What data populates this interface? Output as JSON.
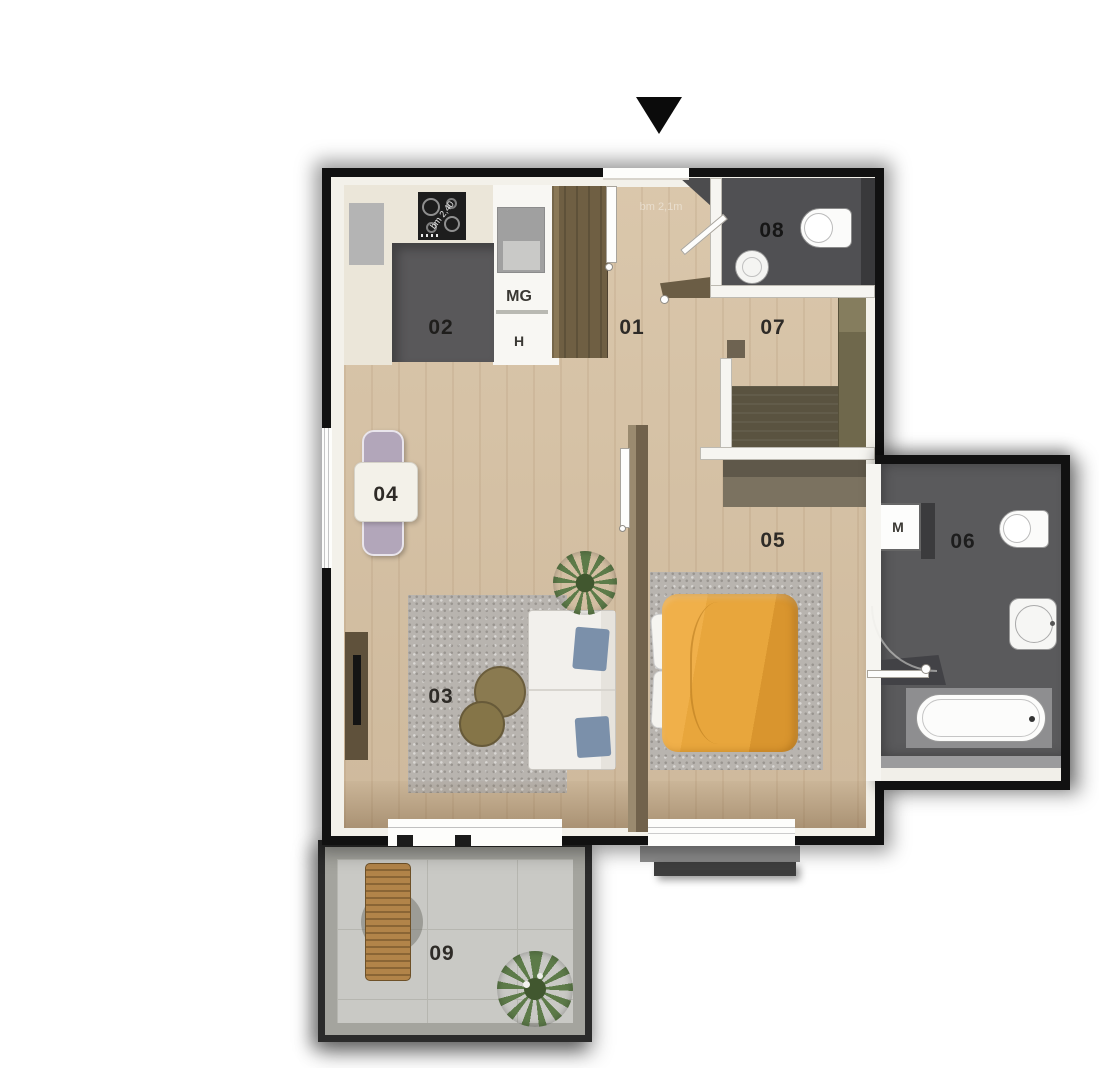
{
  "plan": {
    "title": "apartment-floor-plan",
    "entrance_marker": "down-triangle"
  },
  "rooms": {
    "r01": {
      "label": "01",
      "name": "hallway"
    },
    "r02": {
      "label": "02",
      "name": "kitchen"
    },
    "r03": {
      "label": "03",
      "name": "living-room"
    },
    "r04": {
      "label": "04",
      "name": "dining-nook"
    },
    "r05": {
      "label": "05",
      "name": "bedroom"
    },
    "r06": {
      "label": "06",
      "name": "bathroom"
    },
    "r07": {
      "label": "07",
      "name": "dressing"
    },
    "r08": {
      "label": "08",
      "name": "wc"
    },
    "r09": {
      "label": "09",
      "name": "balcony"
    }
  },
  "annotations": {
    "mg": "MG",
    "h": "H",
    "m": "M",
    "hob_text": "bm 2,40",
    "hall_text": "bm 2,1m"
  },
  "colors": {
    "wood": "#d8c4a7",
    "rug": "#b8b4af",
    "tile-dark": "#565558",
    "wc-floor": "#505053",
    "counter": "#ebe6d9",
    "cabinet": "#f8f7f3",
    "appliance": "#a0a0a0",
    "hall-wardrobe": "#6f5f43",
    "wardrobe-olive": "#6f684c",
    "wardrobe-olive-dark": "#5a5340",
    "separator-wall": "#71624c",
    "duvet": "#e8a63c",
    "sofa": "#f2f0ec",
    "cushion": "#7b90aa",
    "chair": "#b2a6ba",
    "tv-unit": "#5f513b",
    "balcony-floor": "#c9c9c5",
    "lounger": "#b28449",
    "plant": "#5d7b49",
    "sill-light": "#8e8e8e",
    "sill-dark": "#3e3e3e",
    "outer-wall": "#111111"
  }
}
